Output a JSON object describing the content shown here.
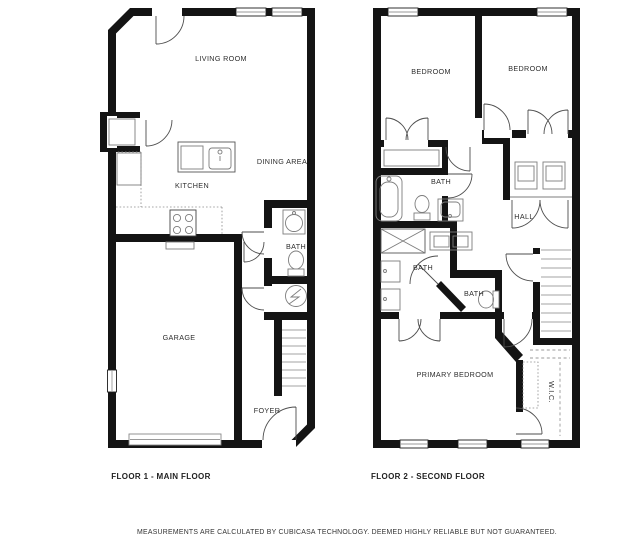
{
  "floor1": {
    "caption": "FLOOR 1 - MAIN FLOOR",
    "rooms": {
      "living_room": "LIVING ROOM",
      "dining_area": "DINING AREA",
      "kitchen": "KITCHEN",
      "bath": "BATH",
      "garage": "GARAGE",
      "foyer": "FOYER"
    }
  },
  "floor2": {
    "caption": "FLOOR 2 - SECOND FLOOR",
    "rooms": {
      "bedroom_left": "BEDROOM",
      "bedroom_right": "BEDROOM",
      "bath_upper": "BATH",
      "hall": "HALL",
      "bath_primary": "BATH",
      "bath_small": "BATH",
      "primary_bedroom": "PRIMARY BEDROOM",
      "wic": "W.I.C."
    }
  },
  "disclaimer": "MEASUREMENTS ARE CALCULATED BY CUBICASA TECHNOLOGY. DEEMED HIGHLY RELIABLE BUT NOT GUARANTEED.",
  "colors": {
    "wall": "#141414",
    "fixture": "#7d7d7d",
    "label": "#2e2e2e"
  }
}
